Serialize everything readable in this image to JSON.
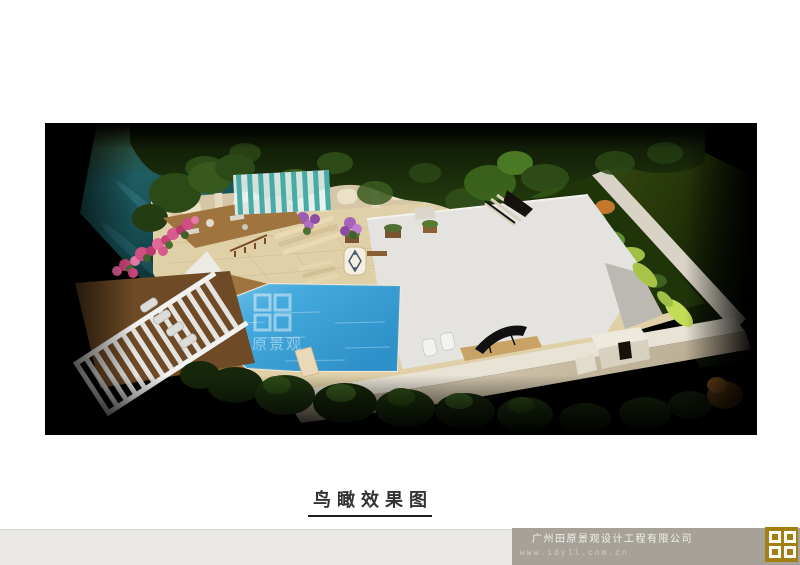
{
  "page": {
    "title": "鸟瞰效果图"
  },
  "footer": {
    "company": "广州田原景观设计工程有限公司",
    "website": "www.idyll.com.cn"
  },
  "render_watermark": {
    "text": "田原景观"
  },
  "theme": {
    "title_color": "#333333",
    "footer_bar": "#a6a299",
    "footer_strip": "#e9e8e5",
    "logo_gold": "#a27f10",
    "pool_blue": "#3fa6d9",
    "paving_tan": "#e0d0a8",
    "roof_gray": "#e4e3e0",
    "wall_beige": "#d5c7a6",
    "deck_brown": "#a0743e",
    "tree_green": "#22380f",
    "river_teal": "#1b565c"
  }
}
